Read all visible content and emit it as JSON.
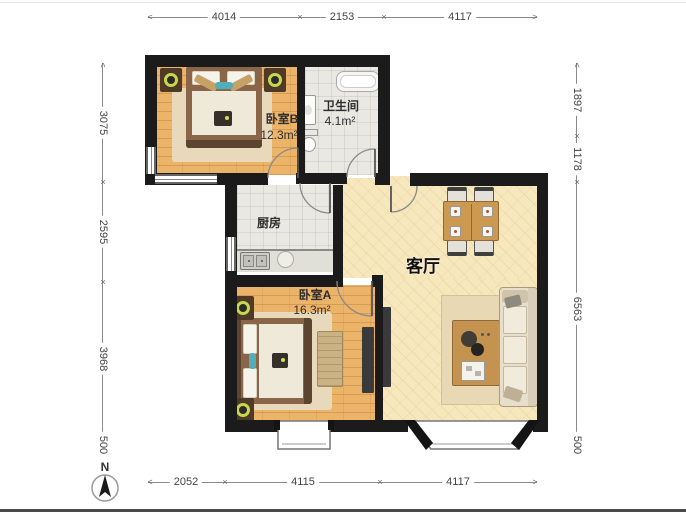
{
  "title": "apartment-floor-plan",
  "dimensions": {
    "top": [
      "4014",
      "2153",
      "4117"
    ],
    "bottom": [
      "2052",
      "4115",
      "4117"
    ],
    "left": [
      "3075",
      "2595",
      "3968",
      "500"
    ],
    "right": [
      "1897",
      "1178",
      "6563",
      "500"
    ]
  },
  "rooms": {
    "bedroomB": {
      "name": "卧室B",
      "area": "12.3m²"
    },
    "bathroom": {
      "name": "卫生间",
      "area": "4.1m²"
    },
    "kitchen": {
      "name": "厨房"
    },
    "living": {
      "name": "客厅"
    },
    "bedroomA": {
      "name": "卧室A",
      "area": "16.3m²"
    }
  },
  "compass": {
    "north_label": "N"
  },
  "glyphs": {
    "tick": "×",
    "arrow_left": "<",
    "arrow_right": ">"
  },
  "colors": {
    "wall": "#1b1b1b",
    "wood_floor": "#ecb469",
    "tile_floor": "#e9e8e3",
    "living_floor": "#f7e7bd",
    "dimension_text": "#444",
    "lamp_accent": "#c9d64b",
    "teal_accent": "#53aebc"
  }
}
